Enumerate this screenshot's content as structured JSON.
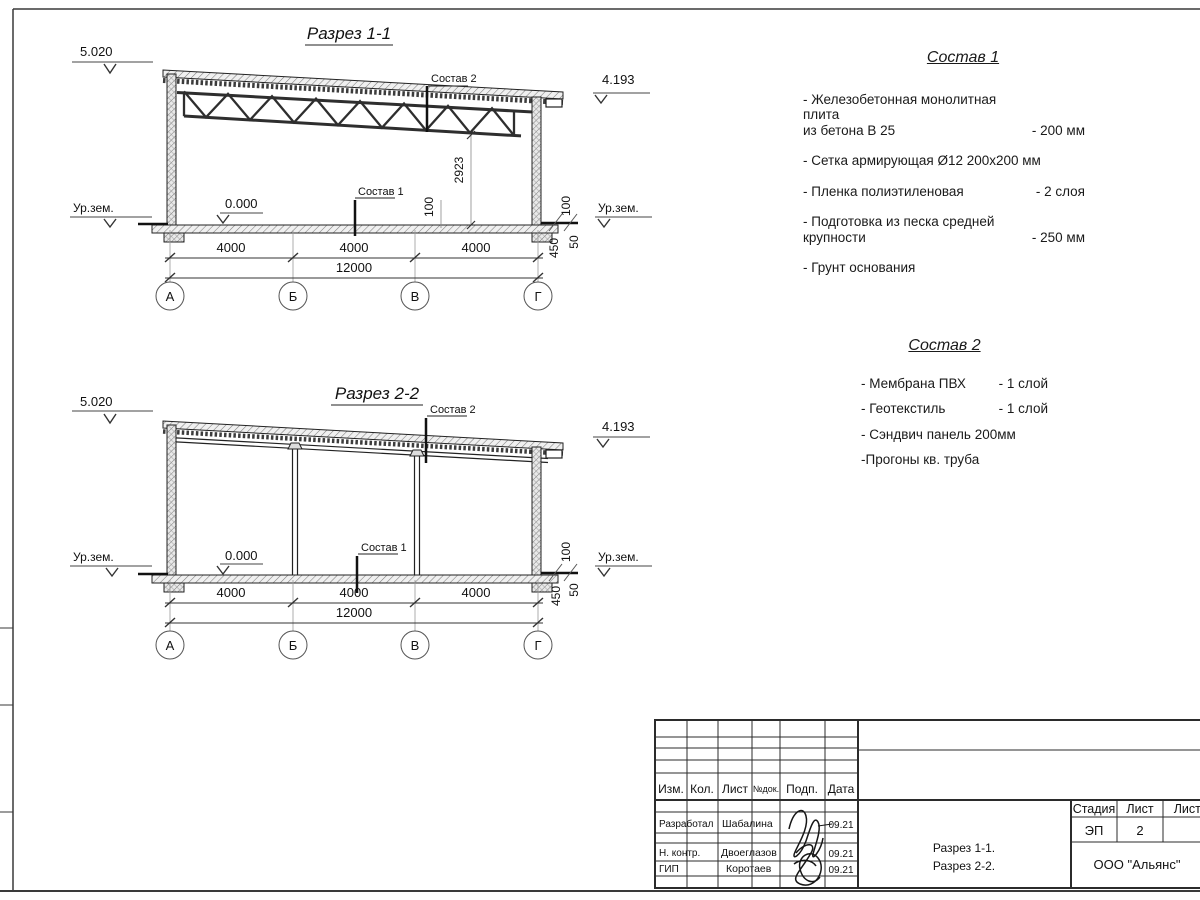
{
  "section1": {
    "title": "Разрез 1-1",
    "elev_left": "5.020",
    "elev_right": "4.193",
    "leader_roof": "Состав 2",
    "leader_floor": "Состав 1",
    "height_dim": "2923",
    "ground_left": "Ур.зем.",
    "ground_right": "Ур.зем.",
    "zero_level": "0.000",
    "dim_100_mid": "100",
    "dim_100_right": "100",
    "dim_450": "450",
    "dim_50": "50",
    "span_dims": [
      "4000",
      "4000",
      "4000"
    ],
    "total_dim": "12000",
    "axes": [
      "А",
      "Б",
      "В",
      "Г"
    ]
  },
  "section2": {
    "title": "Разрез 2-2",
    "elev_left": "5.020",
    "elev_right": "4.193",
    "leader_roof": "Состав 2",
    "leader_floor": "Состав 1",
    "ground_left": "Ур.зем.",
    "ground_right": "Ур.зем.",
    "zero_level": "0.000",
    "dim_100_right": "100",
    "dim_450": "450",
    "dim_50": "50",
    "span_dims": [
      "4000",
      "4000",
      "4000"
    ],
    "total_dim": "12000",
    "axes": [
      "А",
      "Б",
      "В",
      "Г"
    ]
  },
  "sostav1": {
    "title": "Состав 1",
    "items": [
      {
        "name": "- Железобетонная  монолитная плита\nиз бетона В 25",
        "value": "- 200 мм"
      },
      {
        "name": "- Сетка армирующая Ø12 200х200 мм",
        "value": ""
      },
      {
        "name": "- Пленка полиэтиленовая",
        "value": "- 2 слоя"
      },
      {
        "name": "- Подготовка из песка средней\nкрупности",
        "value": "- 250 мм"
      },
      {
        "name": "- Грунт основания",
        "value": ""
      }
    ]
  },
  "sostav2": {
    "title": "Состав 2",
    "items": [
      {
        "name": "- Мембрана ПВХ",
        "value": "- 1 слой"
      },
      {
        "name": "- Геотекстиль",
        "value": "- 1 слой"
      },
      {
        "name": "- Сэндвич панель 200мм",
        "value": ""
      },
      {
        "name": "-Прогоны кв. труба",
        "value": ""
      }
    ]
  },
  "titleblock": {
    "col_izm": "Изм.",
    "col_kol": "Кол.",
    "col_list": "Лист",
    "col_ndok": "№док.",
    "col_podp": "Подп.",
    "col_data": "Дата",
    "rows": [
      {
        "role": "Разработал",
        "name": "Шабалина",
        "date": "09.21"
      },
      {
        "role": "Н. контр.",
        "name": "Двоеглазов",
        "date": "09.21"
      },
      {
        "role": "ГИП",
        "name": "Коротаев",
        "date": "09.21"
      }
    ],
    "doc_line1": "Разрез 1-1.",
    "doc_line2": "Разрез 2-2.",
    "stage_label": "Стадия",
    "sheet_label": "Лист",
    "sheets_label": "Листов",
    "stage_value": "ЭП",
    "sheet_value": "2",
    "company": "ООО \"Альянс\""
  }
}
